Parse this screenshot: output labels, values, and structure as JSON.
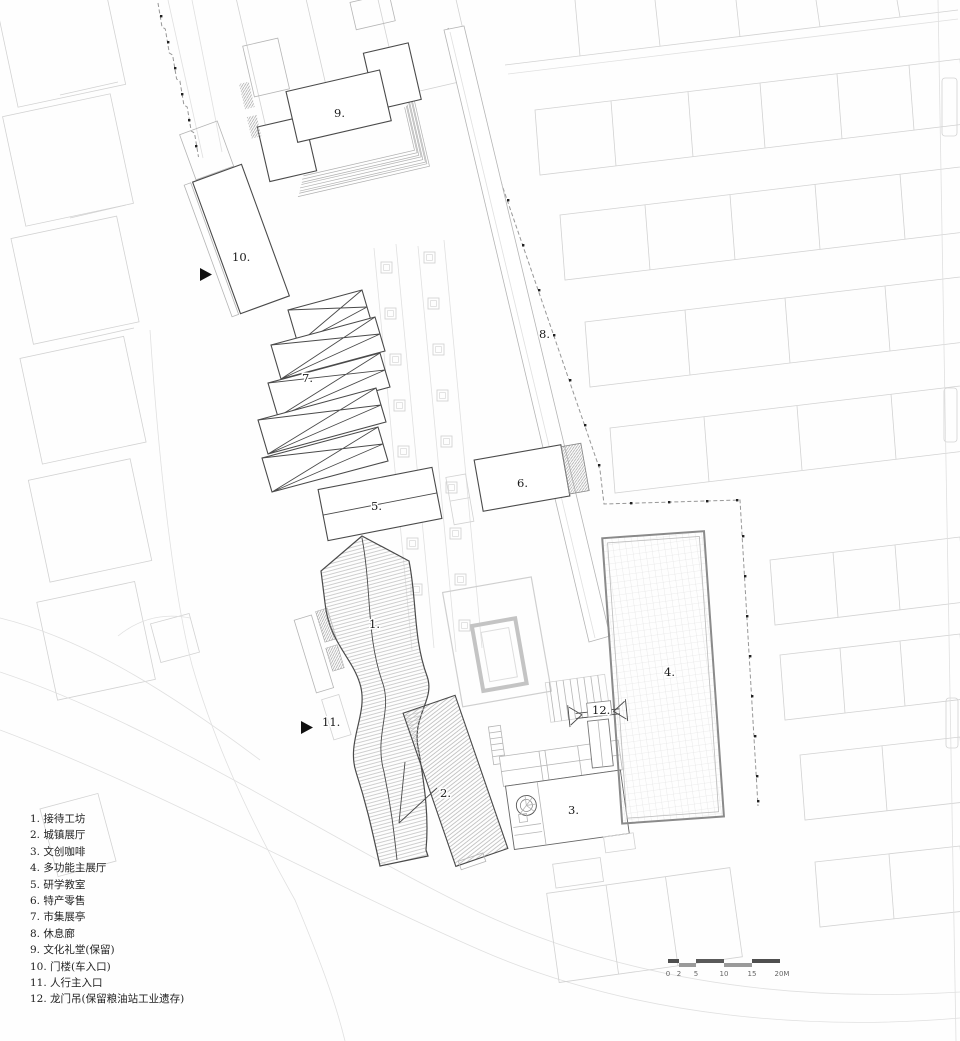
{
  "legend": {
    "items": [
      "1. 接待工坊",
      "2. 城镇展厅",
      "3. 文创咖啡",
      "4. 多功能主展厅",
      "5. 研学教室",
      "6. 特产零售",
      "7. 市集展亭",
      "8. 休息廊",
      "9. 文化礼堂(保留)",
      "10. 门楼(车入口)",
      "11. 人行主入口",
      "12. 龙门吊(保留粮油站工业遗存)"
    ]
  },
  "plan_labels": {
    "b1": "1.",
    "b2": "2.",
    "b3": "3.",
    "b4": "4.",
    "b5": "5.",
    "b6": "6.",
    "b7": "7.",
    "b8": "8.",
    "b9": "9.",
    "b10": "10.",
    "b11": "11.",
    "b12": "12."
  },
  "scale_bar": {
    "ticks": [
      "0",
      "2",
      "5",
      "10",
      "15",
      "20M"
    ]
  },
  "colors": {
    "main_line": "#4a4a4a",
    "context_line": "#d2d2d2",
    "hatch": "#c3c3c3",
    "boundary": "#979797",
    "text": "#1a1a1a",
    "background": "#fefefe"
  }
}
